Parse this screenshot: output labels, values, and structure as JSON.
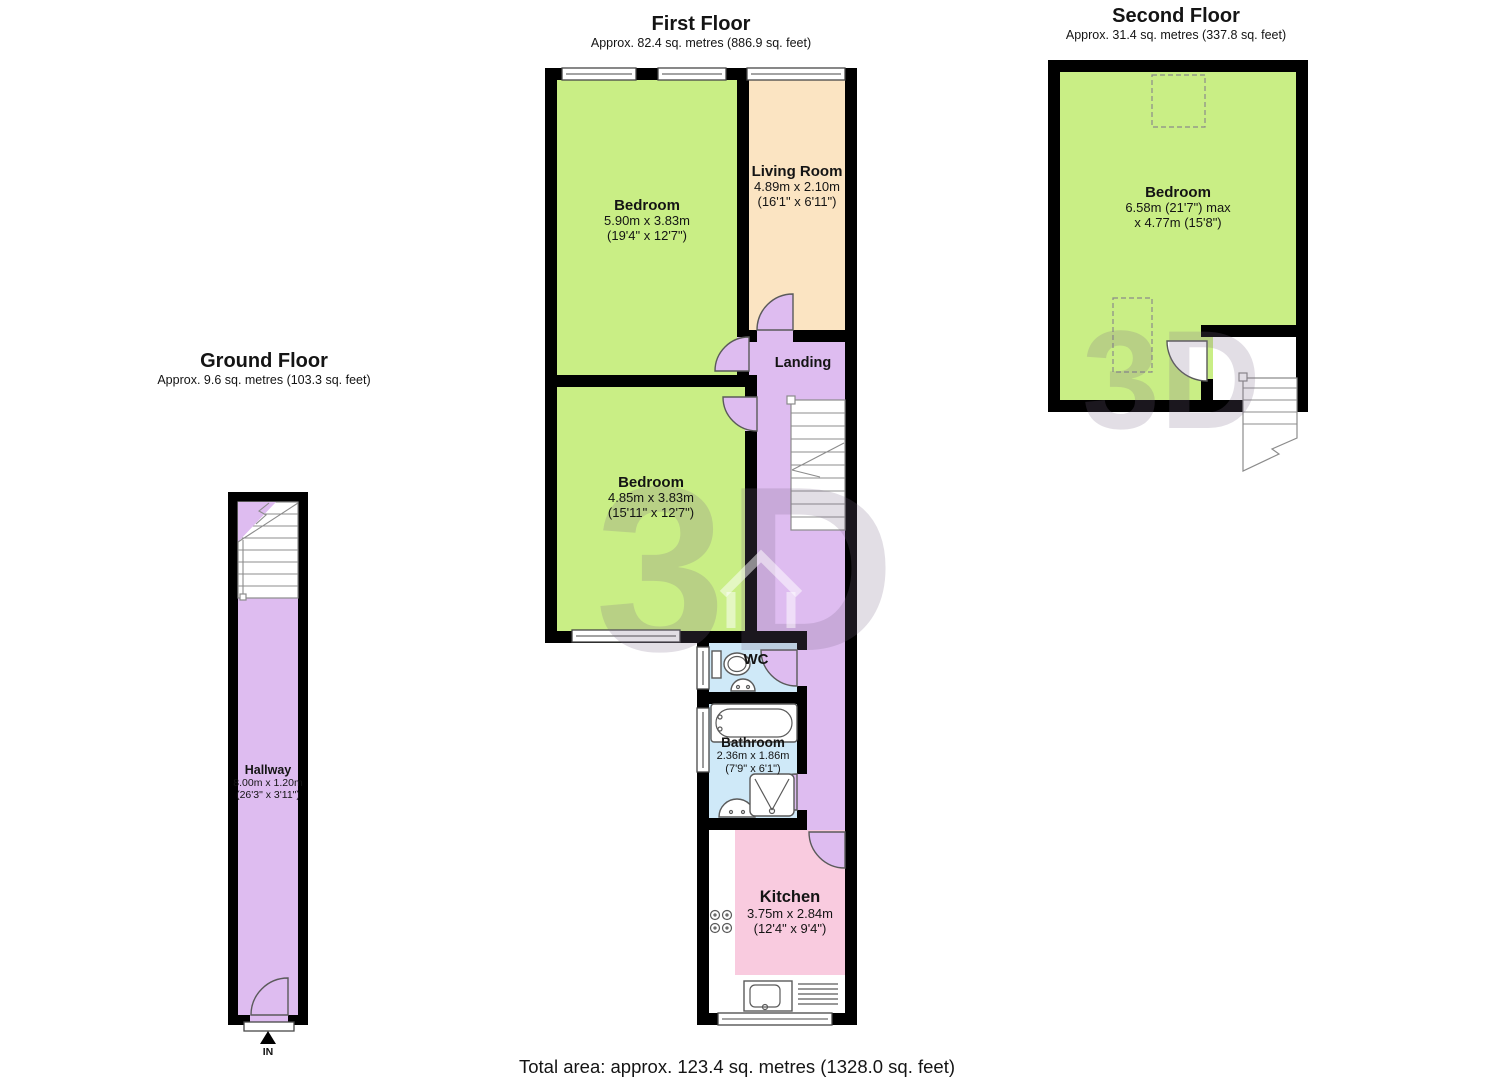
{
  "page": {
    "total_area": "Total area: approx. 123.4 sq. metres (1328.0 sq. feet)",
    "watermark_text": "3D",
    "watermark_text_small": "3D"
  },
  "colors": {
    "wall": "#000000",
    "room_green": "#c9ee85",
    "room_cream": "#fbe4c2",
    "room_purple": "#debcf0",
    "room_blue": "#cfe9f8",
    "room_pink": "#f9cbdf",
    "watermark": "#7a6b8a"
  },
  "floors": {
    "ground": {
      "title": "Ground Floor",
      "subtitle": "Approx. 9.6 sq. metres (103.3 sq. feet)",
      "entrance_label": "IN",
      "rooms": {
        "hallway": {
          "name": "Hallway",
          "dims_metric": "8.00m x 1.20m",
          "dims_imperial": "(26'3\" x 3'11\")"
        }
      }
    },
    "first": {
      "title": "First Floor",
      "subtitle": "Approx. 82.4 sq. metres (886.9 sq. feet)",
      "rooms": {
        "bedroom1": {
          "name": "Bedroom",
          "dims_metric": "5.90m x 3.83m",
          "dims_imperial": "(19'4\" x 12'7\")"
        },
        "living": {
          "name": "Living Room",
          "dims_metric": "4.89m x 2.10m",
          "dims_imperial": "(16'1\" x 6'11\")"
        },
        "landing": {
          "name": "Landing"
        },
        "bedroom2": {
          "name": "Bedroom",
          "dims_metric": "4.85m x 3.83m",
          "dims_imperial": "(15'11\" x 12'7\")"
        },
        "wc": {
          "name": "WC"
        },
        "bathroom": {
          "name": "Bathroom",
          "dims_metric": "2.36m x 1.86m",
          "dims_imperial": "(7'9\" x 6'1\")"
        },
        "kitchen": {
          "name": "Kitchen",
          "dims_metric": "3.75m x 2.84m",
          "dims_imperial": "(12'4\" x 9'4\")"
        }
      }
    },
    "second": {
      "title": "Second Floor",
      "subtitle": "Approx. 31.4 sq. metres (337.8 sq. feet)",
      "rooms": {
        "bedroom": {
          "name": "Bedroom",
          "dims_metric": "6.58m (21'7\") max",
          "dims_imperial": "x 4.77m (15'8\")"
        }
      }
    }
  }
}
